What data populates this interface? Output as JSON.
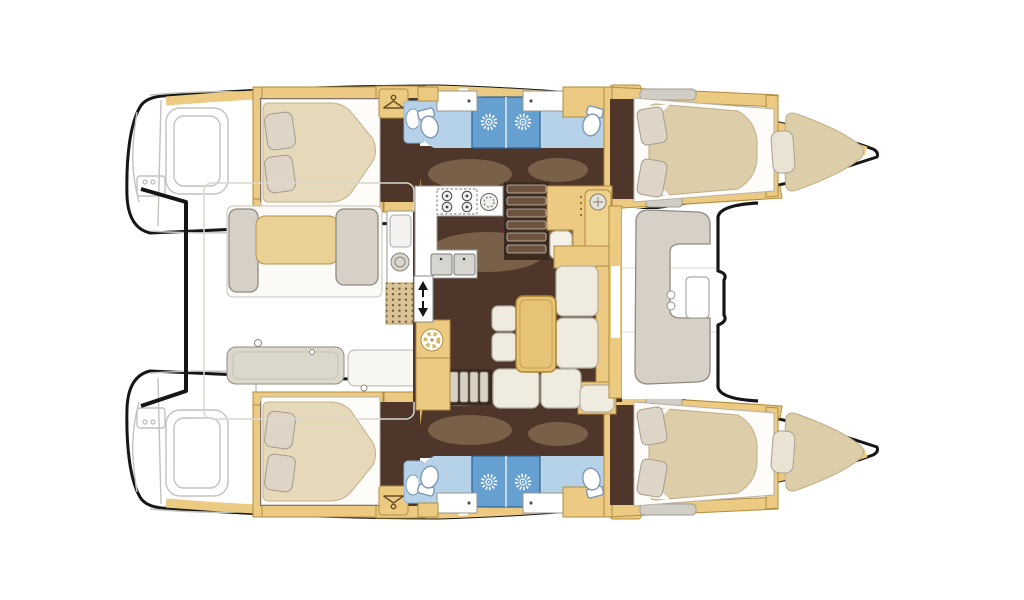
{
  "meta": {
    "title": "Catamaran interior layout floor plan, top-down view, bows to the right",
    "type": "floorplan",
    "view": "top-down"
  },
  "colors": {
    "outline": "#161616",
    "hullFill": "#ffffff",
    "grayLine": "#c4c2bd",
    "wood": "#ecca82",
    "woodDark": "#b08c3e",
    "floor": "#4e362a",
    "floorWash": "#c1a67a",
    "mattress": "#e6d9ba",
    "mattressFwd": "#ddceaa",
    "pillow": "#ded5c6",
    "pillowEdge": "#a39b8d",
    "cushion": "#f0ebdf",
    "cushionEdge": "#b5ada0",
    "bench": "#d6d0c7",
    "benchEdge": "#8f8a80",
    "bathFloor": "#b5d2e8",
    "shower": "#66a0d0",
    "tableTan": "#e7c377",
    "tableEdge": "#a8832e",
    "stepWell": "#3a2a1f"
  },
  "vessel": {
    "type": "catamaran",
    "hulls": 2,
    "double_cabins": 4,
    "bathrooms": 4,
    "shower_stalls": 4,
    "forepeak_berths": 2
  },
  "areas": {
    "port_hull": {
      "name": "Port hull: aft double cabin, twin bathrooms with shower stalls, forward double cabin, forepeak berth"
    },
    "starboard_hull": {
      "name": "Starboard hull: aft double cabin, twin bathrooms with shower stalls, forward double cabin, forepeak berth"
    },
    "aft_cockpit": {
      "name": "Aft cockpit with bench seating, table and wet bar"
    },
    "saloon": {
      "name": "Saloon with L-shaped galley, chart table and settee"
    },
    "forward_cockpit": {
      "name": "Forward cockpit with C-shaped lounge bench"
    },
    "galley": {
      "name": "L-shaped galley with 4-burner stove and double sink"
    },
    "nav_station": {
      "name": "Chart table / navigation station"
    }
  },
  "icons": {
    "hanger": {
      "name": "hanger-icon",
      "meaning": "hanging locker / wardrobe",
      "count": 4
    },
    "shower_drain": {
      "name": "shower-drain-icon",
      "meaning": "shower stall",
      "count": 4
    },
    "stove": {
      "name": "stove-burners-icon",
      "meaning": "4-burner stove",
      "count": 1
    },
    "fan": {
      "name": "fan-icon",
      "meaning": "ventilation / cabinet detail",
      "count": 1
    },
    "door_arrows": {
      "name": "door-arrows-icon",
      "meaning": "sliding entry door",
      "count": 1
    }
  }
}
